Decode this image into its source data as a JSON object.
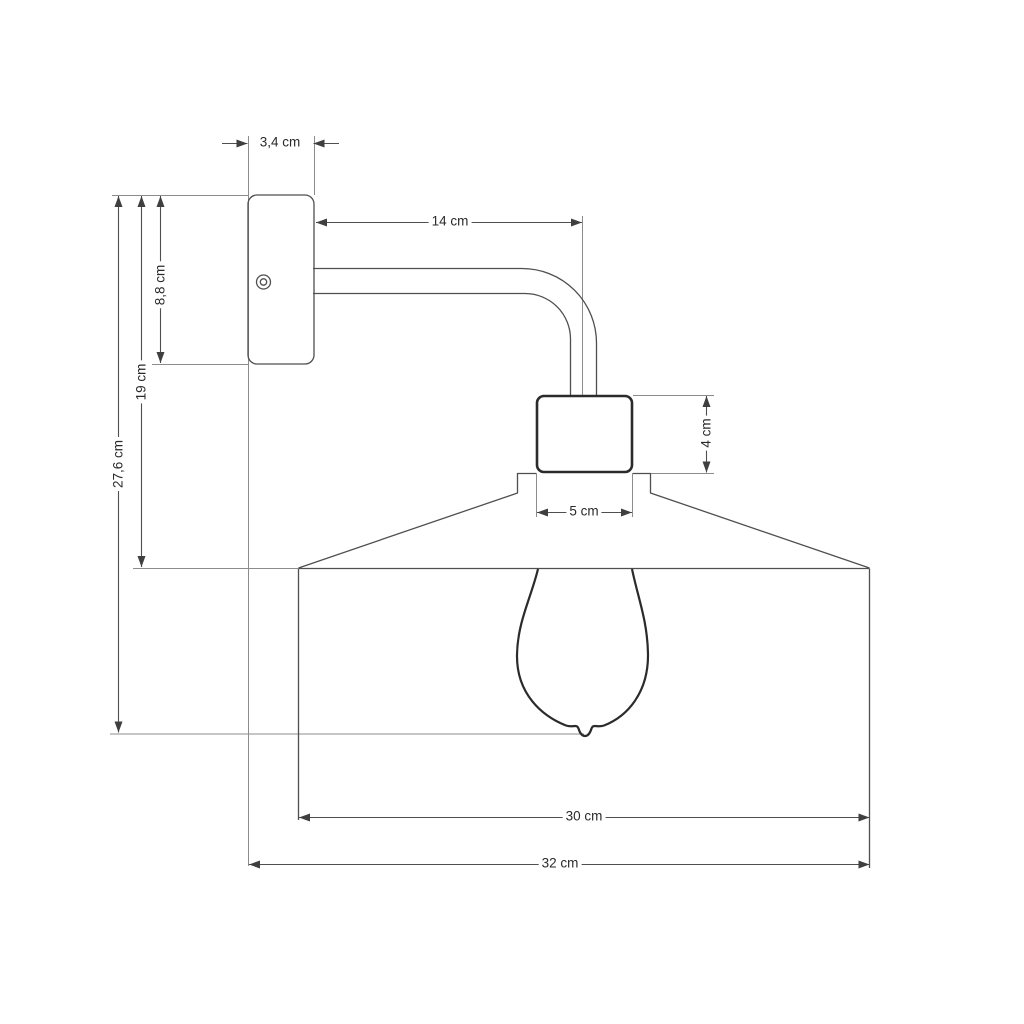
{
  "labels": {
    "plate_width": "3,4 cm",
    "arm_length": "14 cm",
    "plate_height": "8,8 cm",
    "plate_top_to_shade_top": "19 cm",
    "overall_height": "27,6 cm",
    "socket_height": "4 cm",
    "socket_width": "5 cm",
    "shade_diameter": "30 cm",
    "overall_width": "32 cm"
  },
  "colors": {
    "background": "#ffffff",
    "object_line": "#4f4f4f",
    "bold_object_line": "#2b2b2b",
    "extension_line": "#8c8c8c",
    "text": "#2a2a2a"
  }
}
